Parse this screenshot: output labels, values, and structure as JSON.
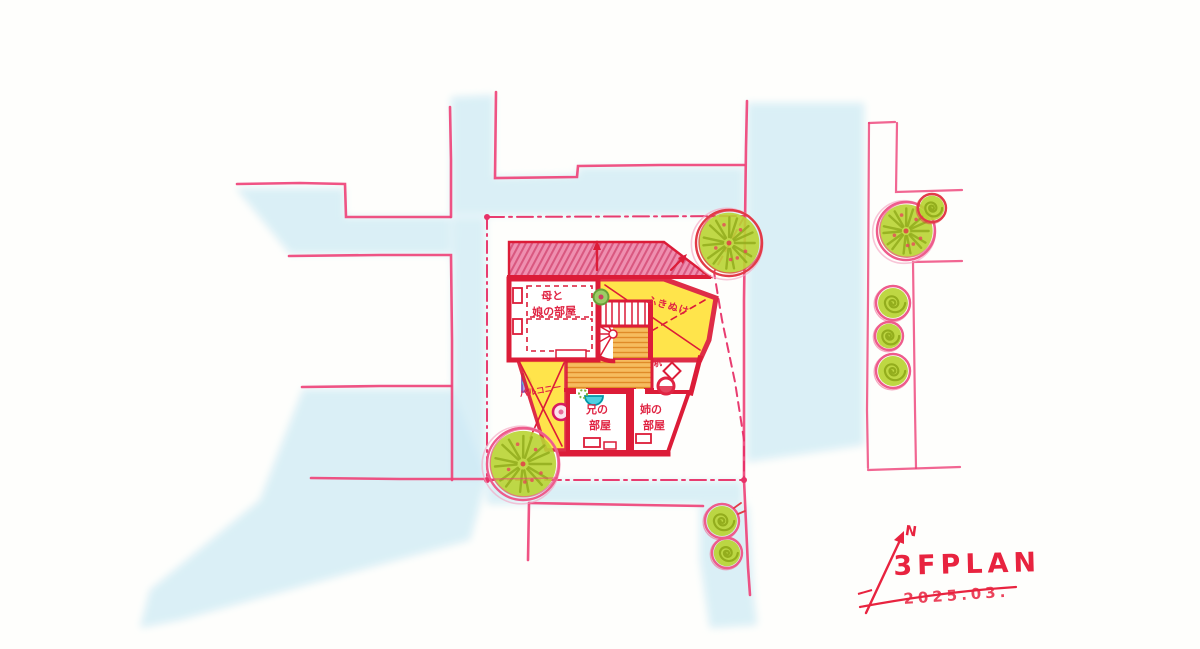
{
  "plan": {
    "title": "3FPLAN",
    "date": "2025.03.",
    "north_label": "N"
  },
  "labels": {
    "mother_daughter_room_line1": "母と",
    "mother_daughter_room_line2": "娘の部屋",
    "void": "ふきぬけ",
    "balcony": "バルコニー",
    "brother_room_line1": "兄の",
    "brother_room_line2": "部屋",
    "sister_room_line1": "姉の",
    "sister_room_line2": "部屋",
    "desk": "机"
  },
  "colors": {
    "road-fill": "#cdeaf4",
    "street-line": "#ee4077",
    "boundary-pink": "#e73268",
    "wall-red": "#dc1c38",
    "roof-pink": "#ef8fb0",
    "roof-hatch": "#d9577f",
    "room-yellow": "#ffe23c",
    "floor-orange": "#f6bc5e",
    "floor-hatch": "#e08b28",
    "tree-green": "#b9d433",
    "tree-stroke": "#93ad1d",
    "tree-outline": "#ee5c8c",
    "tree-outline-red": "#e23b48",
    "label-red": "#e02443",
    "title-red": "#e8233f",
    "furniture-teal": "#4dd0e1",
    "furniture-purple": "#9575cd",
    "furniture-magenta": "#d81b60"
  }
}
